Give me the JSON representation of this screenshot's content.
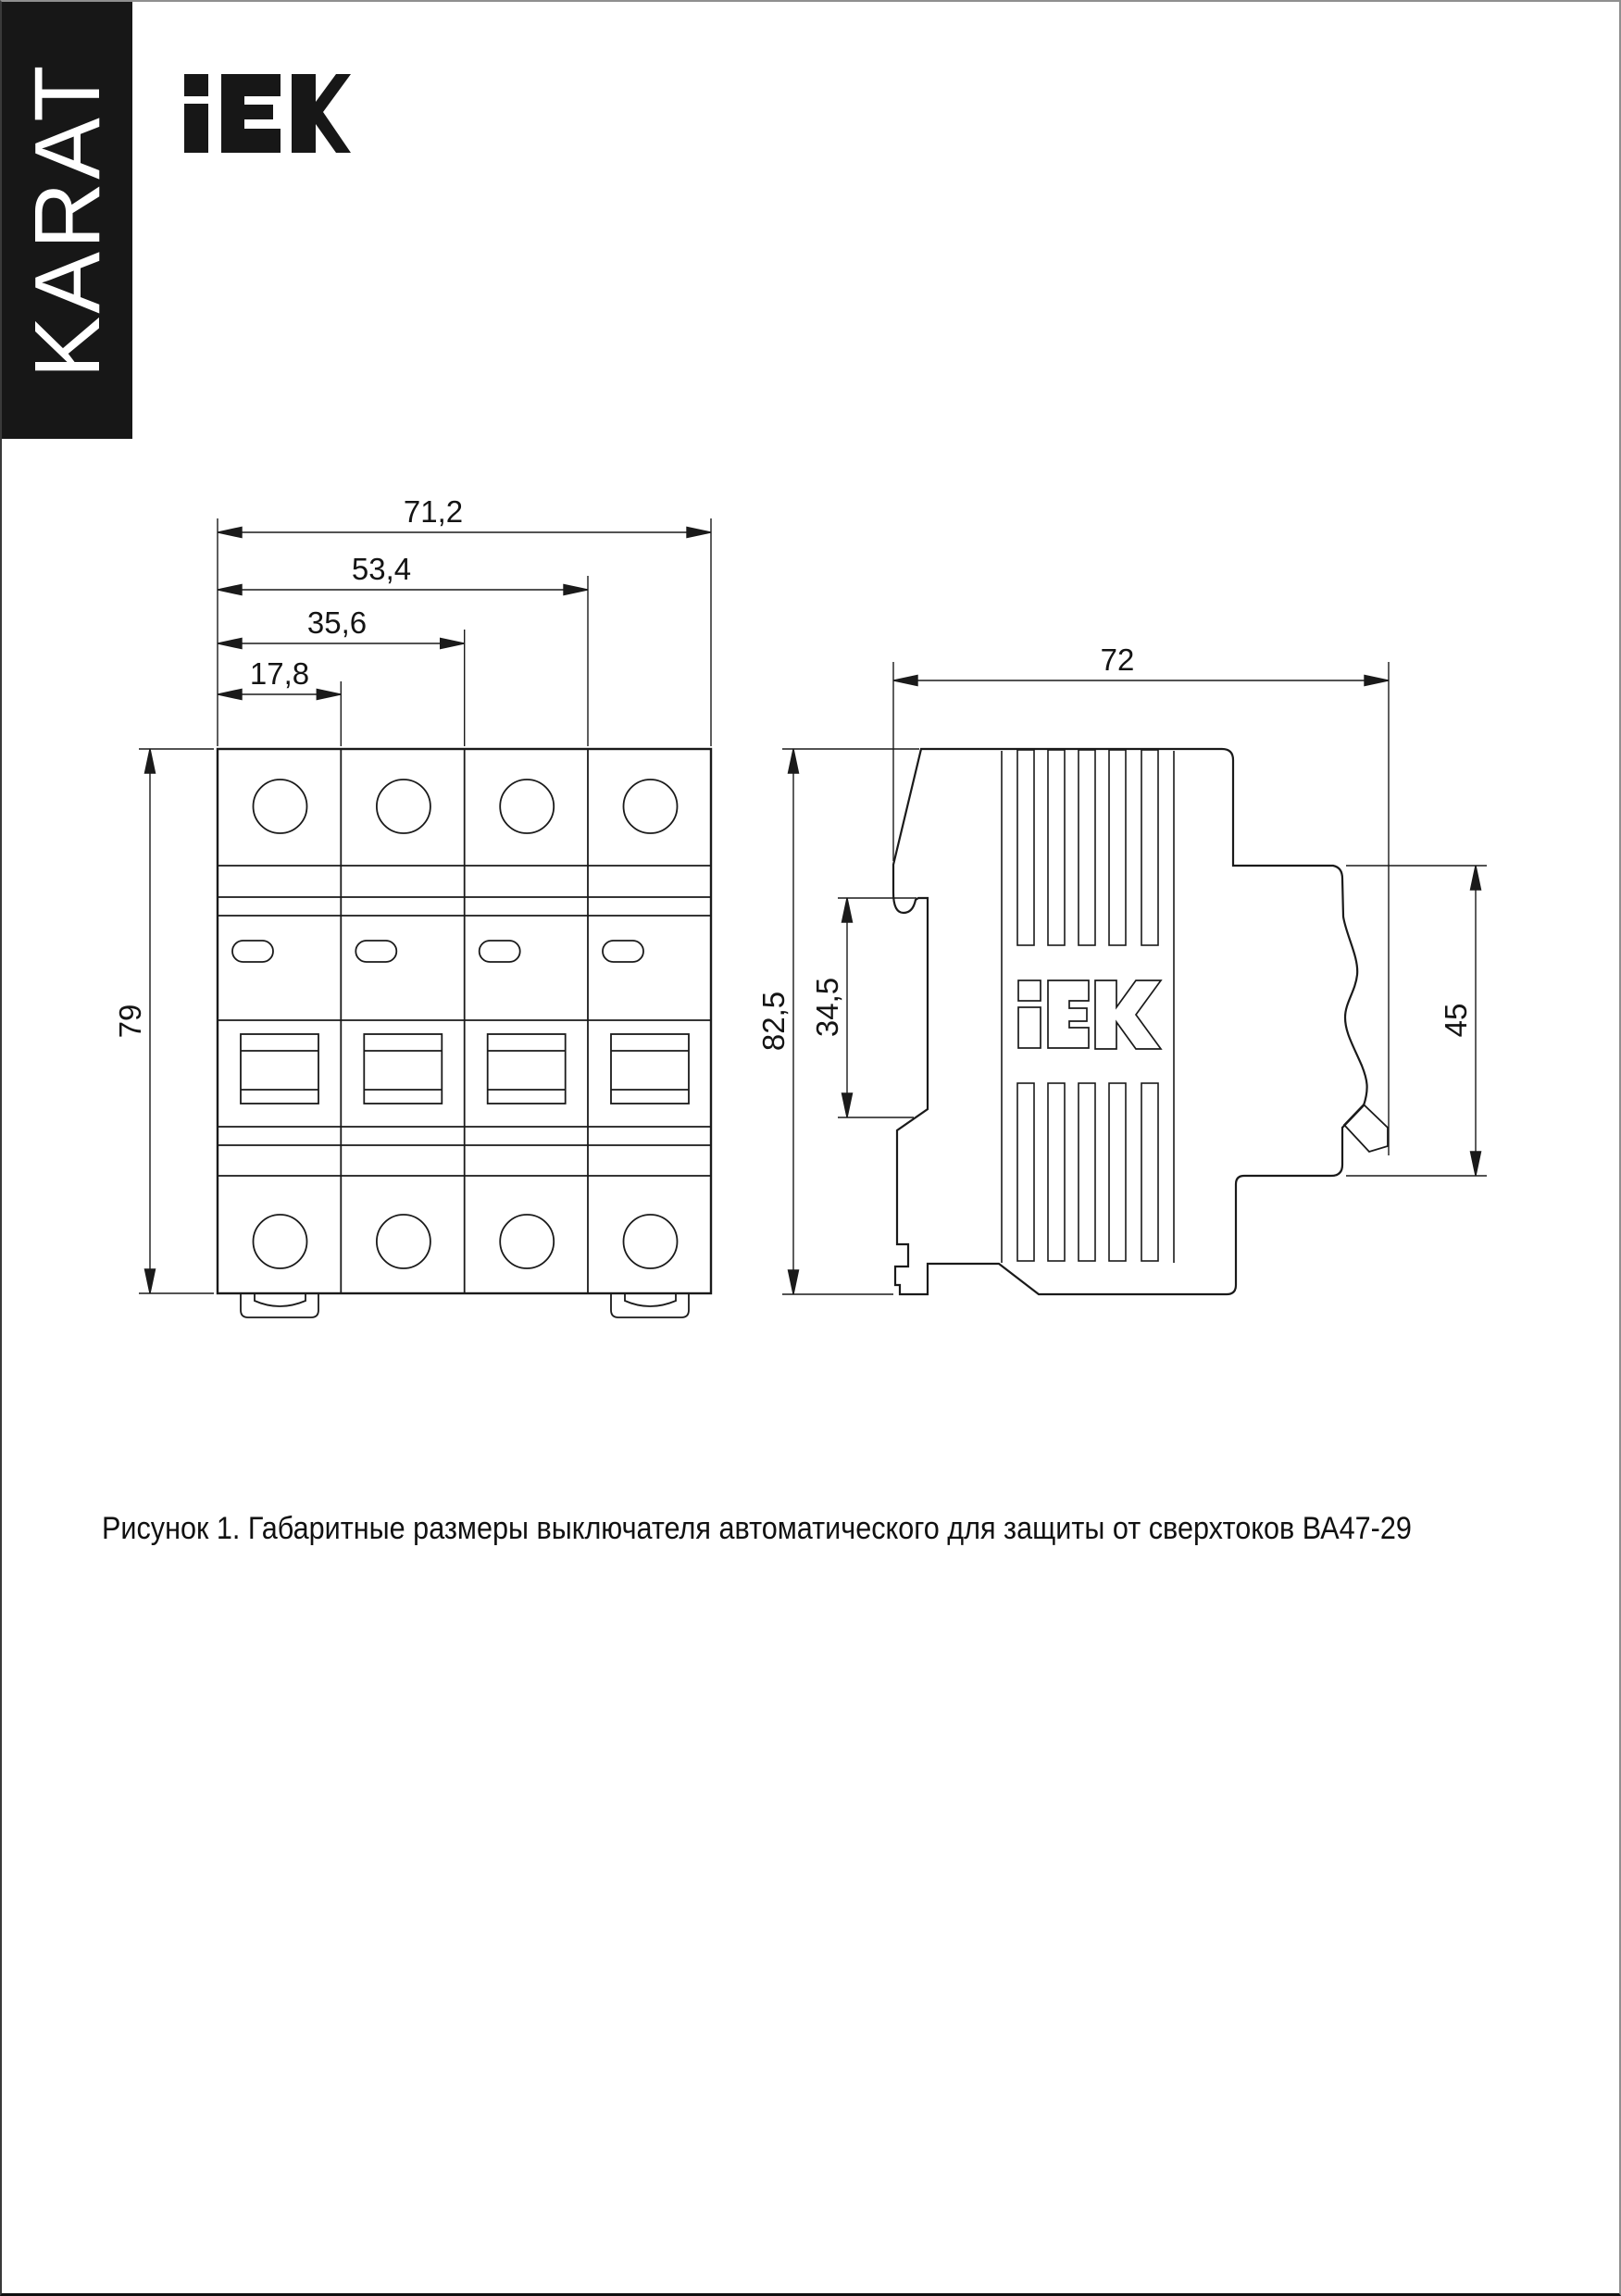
{
  "branding": {
    "karat": "KARAT",
    "logo": "IEK"
  },
  "figure": {
    "caption": "Рисунок 1. Габаритные размеры выключателя автоматического для защиты от сверхтоков ВА47-29"
  },
  "dims": {
    "front": {
      "total_width": "71,2",
      "three_pole_width": "53,4",
      "two_pole_width": "35,6",
      "one_pole_width": "17,8",
      "height": "79"
    },
    "side": {
      "depth": "72",
      "total_height": "82,5",
      "rail_recess_height": "34,5",
      "front_panel_height": "45"
    }
  }
}
